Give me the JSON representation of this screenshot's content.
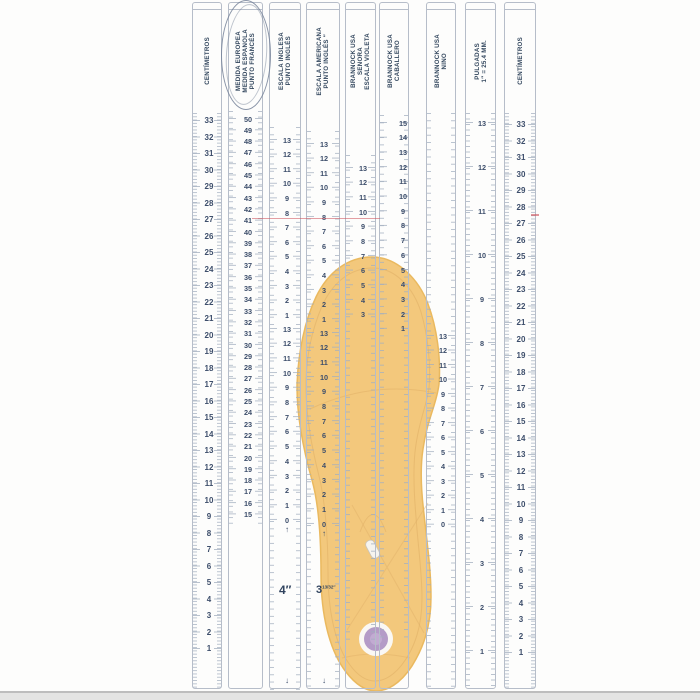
{
  "palette": {
    "strip_border": "#b6bdc9",
    "tick_color": "#a2aebf",
    "number_color": "#3d4e6b",
    "header_color": "#33475e",
    "red_line_color": "#cd505a"
  },
  "insole": {
    "fill": "#f3c87c",
    "edge": "#eab95f",
    "inner_line": "#e2b269",
    "heel_dot_color": "#b49bc7",
    "staple_color": "#f6f4ef"
  },
  "annotations": {
    "inch4": "4″",
    "frac_whole": "3",
    "frac_part": "13/32″"
  },
  "strips": [
    {
      "id": "centimetros-left",
      "x": 192,
      "w": 30,
      "num_x": 208,
      "kind": "cm",
      "fine_div": 5,
      "tick_from": 110,
      "tick_to": 686,
      "header": [
        "CENTÍMETROS"
      ],
      "groups": [
        {
          "y_top": 117.5,
          "step": 16.5,
          "values": [
            33,
            32,
            31,
            30,
            29,
            28,
            27,
            26,
            25,
            24,
            23,
            22,
            21,
            20,
            19,
            18,
            17,
            16,
            15,
            14,
            13,
            12,
            11,
            10,
            9,
            8,
            7,
            6,
            5,
            4,
            3,
            2,
            1
          ]
        }
      ]
    },
    {
      "id": "medida-europea",
      "x": 228,
      "w": 35,
      "num_x": 247,
      "kind": "pt",
      "tick_from": 108,
      "tick_to": 522,
      "header": [
        "MEDIDA EUROPEA",
        "MEDIDA ESPAÑOLA",
        "PUNTO FRANCÉS"
      ],
      "groups": [
        {
          "y_top": 116,
          "step": 11.3,
          "values": [
            50,
            49,
            48,
            47,
            46,
            45,
            44,
            43,
            42,
            41,
            40,
            39,
            38,
            37,
            36,
            35,
            34,
            33,
            32,
            31,
            30,
            29,
            28,
            27,
            26,
            25,
            24,
            23,
            22,
            21,
            20,
            19,
            18,
            17,
            16,
            15
          ]
        }
      ]
    },
    {
      "id": "escala-inglesa",
      "x": 269,
      "w": 32,
      "num_x": 286,
      "kind": "pt",
      "tick_from": 124,
      "tick_to": 688,
      "bottom_marker": "↓",
      "header": [
        "ESCALA INGLESA",
        "PUNTO INGLÉS"
      ],
      "groups": [
        {
          "y_top": 137,
          "step": 14.6,
          "values": [
            13,
            12,
            11,
            10,
            9,
            8,
            7,
            6,
            5,
            4,
            3,
            2,
            1
          ]
        },
        {
          "y_top": 326,
          "step": 14.7,
          "values": [
            13,
            12,
            11,
            10,
            9,
            8,
            7,
            6,
            5,
            4,
            3,
            2,
            1,
            0
          ],
          "marker": "↑"
        }
      ]
    },
    {
      "id": "escala-americana",
      "x": 306,
      "w": 34,
      "num_x": 323,
      "kind": "pt",
      "tick_from": 128,
      "tick_to": 688,
      "bottom_marker": "↓",
      "header": [
        "ESCALA AMERICANA",
        "PUNTO INGLÉS ″"
      ],
      "groups": [
        {
          "y_top": 141,
          "step": 14.6,
          "values": [
            13,
            12,
            11,
            10,
            9,
            8,
            7,
            6,
            5,
            4,
            3,
            2,
            1
          ]
        },
        {
          "y_top": 330,
          "step": 14.7,
          "values": [
            13,
            12,
            11,
            10,
            9,
            8,
            7,
            6,
            5,
            4,
            3,
            2,
            1,
            0
          ],
          "marker": "↑"
        }
      ]
    },
    {
      "id": "brannock-senora",
      "x": 345,
      "w": 31,
      "num_x": 362,
      "kind": "pt",
      "tick_from": 152,
      "tick_to": 640,
      "header": [
        "BRANNOCK USA",
        "SEÑORA",
        "ESCALA VIOLETA"
      ],
      "groups": [
        {
          "y_top": 165,
          "step": 14.67,
          "values": [
            13,
            12,
            11,
            10,
            9,
            8,
            7,
            6,
            5,
            4,
            3
          ]
        }
      ]
    },
    {
      "id": "brannock-caballero",
      "x": 379,
      "w": 30,
      "num_x": 402,
      "kind": "pt",
      "tick_from": 112,
      "tick_to": 640,
      "header": [
        "BRANNOCK USA",
        "CABALLERO"
      ],
      "groups": [
        {
          "y_top": 120,
          "step": 14.71,
          "values": [
            15,
            14,
            13,
            12,
            11,
            10,
            9,
            8,
            7,
            6,
            5,
            4,
            3,
            2,
            1
          ]
        }
      ]
    },
    {
      "id": "brannock-nino",
      "x": 426,
      "w": 30,
      "num_x": 442,
      "kind": "pt",
      "tick_from": 110,
      "tick_to": 686,
      "header": [
        "BRANNOCK USA",
        "NIÑO"
      ],
      "groups": [
        {
          "y_top": 333,
          "step": 14.52,
          "values": [
            13,
            12,
            11,
            10,
            9,
            8,
            7,
            6,
            5,
            4,
            3,
            2,
            1,
            0
          ]
        }
      ]
    },
    {
      "id": "pulgadas",
      "x": 465,
      "w": 31,
      "num_x": 481,
      "kind": "pt",
      "fine_div": 8,
      "tick_from": 110,
      "tick_to": 686,
      "header": [
        "PULGADAS",
        "1″ = 25.4 MM."
      ],
      "groups": [
        {
          "y_top": 120,
          "step": 44,
          "values": [
            13,
            12,
            11,
            10,
            9,
            8,
            7,
            6,
            5,
            4,
            3,
            2,
            1
          ]
        }
      ]
    },
    {
      "id": "centimetros-right",
      "x": 504,
      "w": 32,
      "num_x": 520,
      "kind": "cm",
      "fine_div": 5,
      "tick_from": 110,
      "tick_to": 686,
      "header": [
        "CENTÍMETROS"
      ],
      "groups": [
        {
          "y_top": 121.5,
          "step": 16.5,
          "values": [
            33,
            32,
            31,
            30,
            29,
            28,
            27,
            26,
            25,
            24,
            23,
            22,
            21,
            20,
            19,
            18,
            17,
            16,
            15,
            14,
            13,
            12,
            11,
            10,
            9,
            8,
            7,
            6,
            5,
            4,
            3,
            2,
            1
          ]
        }
      ]
    }
  ]
}
